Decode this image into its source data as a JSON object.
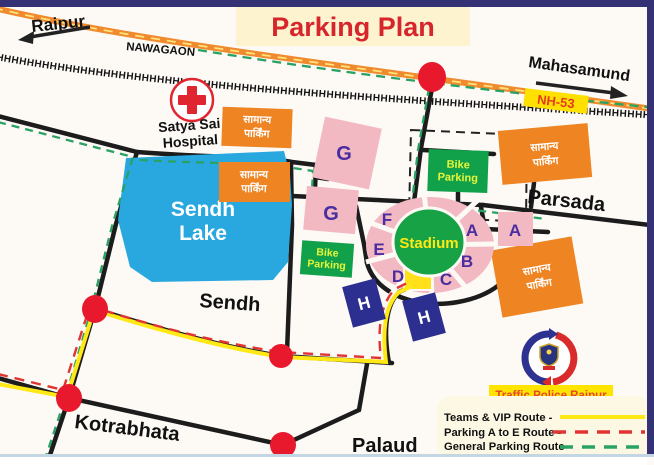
{
  "title": "Parking Plan",
  "labels": {
    "raipur": "Raipur",
    "nawagaon": "NAWAGAON",
    "mahasamund": "Mahasamund",
    "nh53": "NH-53",
    "hospital_line1": "Satya Sai",
    "hospital_line2": "Hospital",
    "parsada": "Parsada",
    "sendh_village": "Sendh",
    "kotrabhata": "Kotrabhata",
    "palaud": "Palaud",
    "lake_line1": "Sendh",
    "lake_line2": "Lake",
    "stadium": "Stadium"
  },
  "zones": {
    "g1": "G",
    "g2": "G",
    "f": "F",
    "e": "E",
    "d": "D",
    "a1": "A",
    "b": "B",
    "c": "C",
    "a2": "A"
  },
  "parking_labels": {
    "general_line1": "सामान्य",
    "general_line2": "पार्किंग",
    "bike_line1": "Bike",
    "bike_line2": "Parking",
    "helipad": "H"
  },
  "railway": {
    "pattern": "HHHHHHHHHHHHHHHHHHHHHHHHHHHHHHHHHHHHHHHHHHHHHHHHHHHHHHHHHHHHHHHHHHHHHHHHHHHHHHHHHHHHHHHHHHHHHHHHHHHHHHHHHH"
  },
  "police": {
    "caption": "Traffic Police Raipur"
  },
  "legend": {
    "items": [
      {
        "label": "Teams & VIP Route -",
        "line_style": "solid",
        "color": "#ffe815"
      },
      {
        "label": "Parking A to E Route -",
        "line_style": "dashed",
        "color": "#e23333"
      },
      {
        "label": "General Parking Route -",
        "line_style": "dashed",
        "color": "#2aa264"
      }
    ]
  },
  "colors": {
    "title_red": "#d6252b",
    "title_bg": "#fdf3cf",
    "highway_orange": "#ef8b2e",
    "road_black": "#1c1c1c",
    "route_vip_yellow": "#ffe815",
    "route_ae_red": "#e23333",
    "route_general_green": "#2aa264",
    "lake_blue": "#29a8e0",
    "zone_pink": "#f3b9c3",
    "zone_letter_purple": "#4a2da0",
    "stadium_green": "#17a345",
    "parking_orange": "#ee8422",
    "bike_green": "#12a14b",
    "helipad_navy": "#2c2f8f",
    "junction_red": "#e8192c",
    "badge_yellow": "#ffe000"
  }
}
